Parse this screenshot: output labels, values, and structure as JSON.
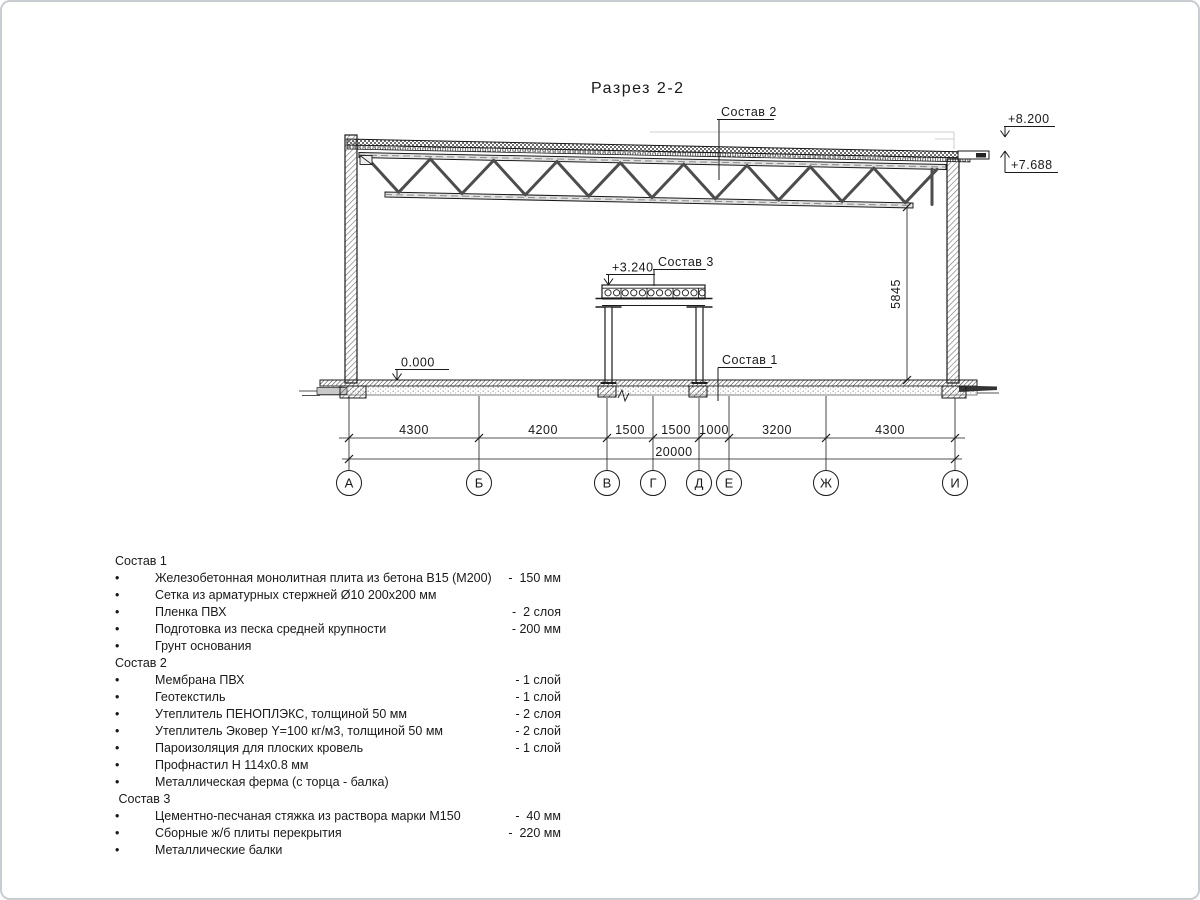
{
  "title": "Разрез 2-2",
  "drawing": {
    "labels": {
      "sostav1": "Состав 1",
      "sostav2": "Состав 2",
      "sostav3": "Состав 3"
    },
    "elevations": {
      "roof_top": "+8.200",
      "roof_bottom": "+7.688",
      "mezzanine": "+3.240",
      "floor": "0.000"
    },
    "vertical_dim": "5845",
    "dims": [
      "4300",
      "4200",
      "1500",
      "1500",
      "1000",
      "3200",
      "4300"
    ],
    "total_dim": "20000",
    "axes": [
      "А",
      "Б",
      "В",
      "Г",
      "Д",
      "Е",
      "Ж",
      "И"
    ]
  },
  "legend": {
    "sections": [
      {
        "header": "Состав 1",
        "items": [
          {
            "name": "Железобетонная монолитная плита из бетона В15 (М200)",
            "value": "-  150 мм"
          },
          {
            "name": "Сетка из арматурных стержней Ø10 200x200 мм",
            "value": ""
          },
          {
            "name": "Пленка ПВХ",
            "value": "-  2 слоя"
          },
          {
            "name": "Подготовка из песка средней крупности",
            "value": "- 200 мм"
          },
          {
            "name": "Грунт основания",
            "value": ""
          }
        ]
      },
      {
        "header": "Состав 2",
        "items": [
          {
            "name": "Мембрана ПВХ",
            "value": "- 1 слой"
          },
          {
            "name": "Геотекстиль",
            "value": "- 1 слой"
          },
          {
            "name": "Утеплитель ПЕНОПЛЭКС, толщиной 50 мм",
            "value": "- 2 слоя"
          },
          {
            "name": "Утеплитель Эковер Y=100 кг/м3, толщиной 50 мм",
            "value": "- 2 слой"
          },
          {
            "name": "Пароизоляция для плоских кровель",
            "value": "- 1 слой"
          },
          {
            "name": "Профнастил Н 114x0.8 мм",
            "value": ""
          },
          {
            "name": "Металлическая ферма (с торца - балка)",
            "value": ""
          }
        ]
      },
      {
        "header": " Состав 3",
        "items": [
          {
            "name": "Цементно-песчаная стяжка из раствора марки М150",
            "value": "-  40 мм"
          },
          {
            "name": "Сборные ж/б плиты перекрытия",
            "value": "-  220 мм"
          },
          {
            "name": "Металлические балки",
            "value": ""
          }
        ]
      }
    ]
  }
}
